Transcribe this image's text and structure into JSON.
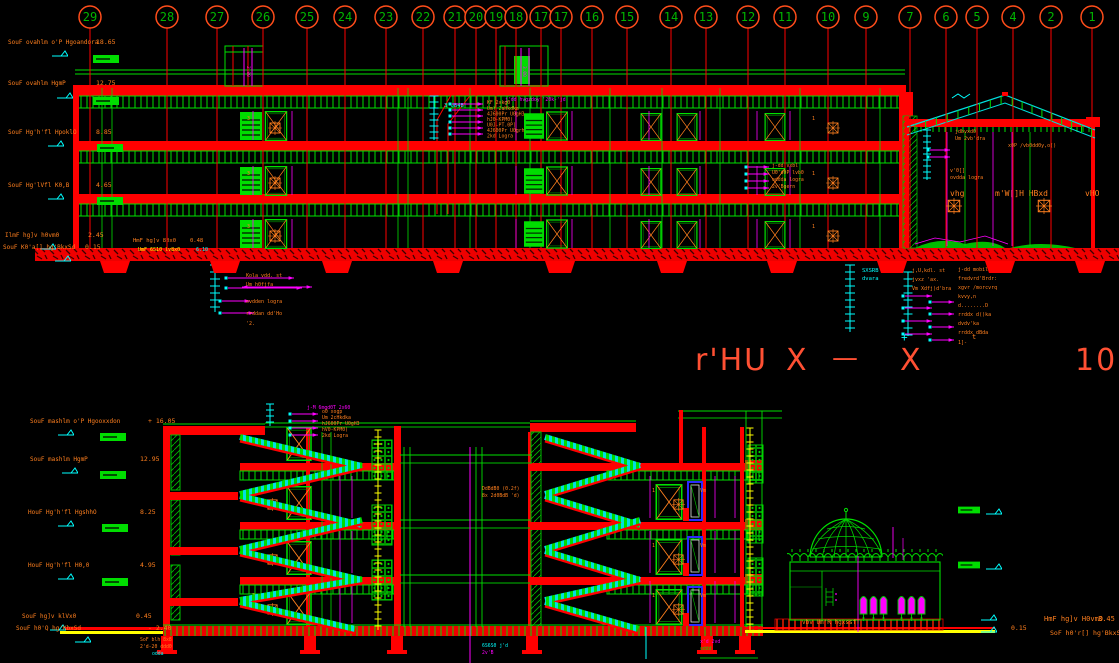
{
  "app": {
    "background": "#000000",
    "type_label": "CAD section drawing"
  },
  "colors": {
    "red": "#ff0000",
    "green": "#00e000",
    "cyan": "#00ffff",
    "magenta": "#ff00ff",
    "orange": "#ff7f1e",
    "yellow": "#ffff00",
    "blue": "#2a2aff",
    "title": "#ff5033",
    "bubble_ring": "#ff4d1a",
    "bubble_num": "#00b400"
  },
  "grid": {
    "bubbles": [
      "29",
      "28",
      "27",
      "26",
      "25",
      "24",
      "23",
      "22",
      "21",
      "20",
      "19",
      "18",
      "17",
      "17",
      "16",
      "15",
      "14",
      "13",
      "12",
      "11",
      "10",
      "9",
      "7",
      "6",
      "5",
      "4",
      "2",
      "1"
    ]
  },
  "levels_top": [
    {
      "label": "SouF ovahlm o'P Hgoandora",
      "value": "18.65"
    },
    {
      "label": "SouF ovahlm HgmP",
      "value": "12.75"
    },
    {
      "label": "SouF  Hg'h'fl HpoklO",
      "value": "8.85"
    },
    {
      "label": "SouF  Hg'lVfl K0,B",
      "value": "4.65"
    },
    {
      "label": "IlmF  hg]v h0vm0",
      "value": "2.45"
    },
    {
      "label": "SouF K0'a[] hg'BkxSd",
      "value": "0.15"
    }
  ],
  "levels_bottom": [
    {
      "label": "SouF mashlm o'P Hgooxxdon",
      "value": "+ 16.05"
    },
    {
      "label": "SouF mashlm HgmP",
      "value": "12.95"
    },
    {
      "label": "HouF  Hg'h'fl HgshhO",
      "value": "8.25"
    },
    {
      "label": "HouF  Hg'h'fl H0,0",
      "value": "4.95"
    },
    {
      "label": "SouF  hg]v klVx0",
      "value": "0.45"
    },
    {
      "label": "SouF h0'Q hg'KbxSd",
      "value": "- 2.40"
    }
  ],
  "title": {
    "section": "r'HU",
    "axis_left": "X",
    "dash": "—",
    "axis_right": "X",
    "scale": "100",
    "plus": "+",
    "tick": "t"
  },
  "penthouse": {
    "dim1": "2.80",
    "dim2": "3.00"
  },
  "roof_note": {
    "cyan": "3'UB4B",
    "magenta": "j'dd hvgzdoy '20k-'jd",
    "lines": [
      "KF 2xkg0",
      "Um) 2aHkdka",
      "4J600Pr U0gH3",
      "hJ0-KPM0)",
      "U0J-PT.0P]",
      "4J600Pr U0grh",
      "2kd Logra"
    ]
  },
  "roof_note2": {
    "magenta": "j-M 6mgd0T 2x60",
    "lines": [
      "o0 xogp",
      "Um 2cHkdka",
      "hJ600Pr U0gH3",
      "hV0-KPM0)",
      "2kd Logra"
    ]
  },
  "floor2_note": {
    "lines": [
      "j-dd vxbl",
      "U0'd0P lvb0",
      "oddda logra",
      "2v'Bgern"
    ]
  },
  "hall": {
    "left": "vhg",
    "mid": "m'W[]H HBxd",
    "right": "vHO",
    "rows": [
      "jdbvxd0",
      "Um 2vb'dra",
      "x0P /vb0dd0y,o()",
      "v'0[]",
      "ovdda logra"
    ]
  },
  "ground_note": {
    "l1": "HmF  hg]v 80x0",
    "v1": "0.48",
    "l2": "UmF 6S10 lv8x0",
    "v2": "6.10"
  },
  "legend_left": {
    "rows": [
      "Kola vdd. st",
      "Um h0fjfa",
      "ovdden logra",
      "rrddan dd'Ho",
      "'2."
    ]
  },
  "legend_right": {
    "cyan": [
      "SXSRB",
      "dvara"
    ],
    "col1": [
      "j,U,kdl. st",
      "jvxz 'ax.",
      "Vm Xdfj)d'bra"
    ],
    "col2": [
      "j-dd mobile-jdd 'B",
      "fredvrd'Brdr:",
      "xgvr /morcvrq",
      "kvvy,n",
      "d........D",
      "rrddx d()ka",
      "dvdv'ka",
      "rrddx dBda",
      "1]-"
    ]
  },
  "stair_note": {
    "lines": [
      "DdBdB0 (0.2f)",
      "8x 2d0BdB 'd)"
    ]
  },
  "floor_marks": {
    "m1": "1",
    "m2": "3",
    "m3": "Vm"
  },
  "mosque": {
    "note": "vbv Um'R hgxssfT",
    "level": "0.15"
  },
  "corner_labels": {
    "l1": "HmF  hg]v H0vm0",
    "v1": "3.45",
    "l2": "SoF h0'r[] hg'BkxSd"
  },
  "bottom_left_cluster": [
    "SoF blh 8x8",
    "2'd-20 ddd0",
    "odda"
  ],
  "bottom_mid_cluster": [
    "6S6S0  j'd",
    "2v'B"
  ],
  "bottom_mid2_cluster": [
    "x'd 2vd",
    "oddd"
  ]
}
